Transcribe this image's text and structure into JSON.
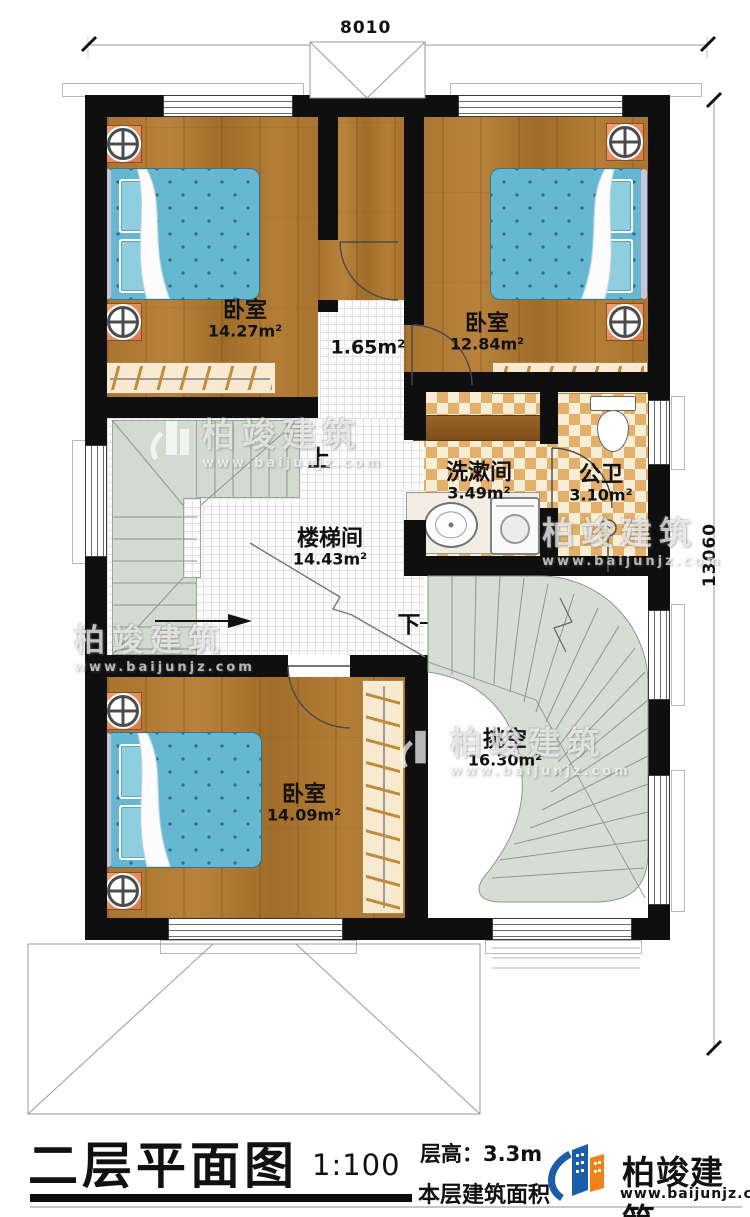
{
  "dimensions": {
    "top": "8010",
    "right": "13060"
  },
  "rooms": {
    "bedroom_tl": {
      "name": "卧室",
      "area": "14.27m²"
    },
    "bedroom_tr": {
      "name": "卧室",
      "area": "12.84m²"
    },
    "hall": {
      "area": "1.65m²"
    },
    "washroom": {
      "name": "洗漱间",
      "area": "3.49m²"
    },
    "toilet": {
      "name": "公卫",
      "area": "3.10m²"
    },
    "stairwell": {
      "name": "楼梯间",
      "area": "14.43m²"
    },
    "bedroom_b": {
      "name": "卧室",
      "area": "14.09m²"
    },
    "void": {
      "name": "挑空",
      "area": "16.30m²"
    }
  },
  "stairs": {
    "up": "上",
    "down": "下"
  },
  "watermark": {
    "brand": "柏竣建筑",
    "site": "www.baijunjz.com"
  },
  "titleblock": {
    "title": "二层平面图",
    "scale": "1:100",
    "floor_height": "层高：3.3m",
    "floor_area": "本层建筑面积",
    "brand": "柏竣建筑",
    "site": "www.baijunjz.com"
  },
  "colors": {
    "wood": "#ab7530",
    "bed_blue": "#66b8d2",
    "checker_tan": "#e3af6b",
    "stair_green": "#d3dbd0",
    "brand_blue": "#1a5dab",
    "brand_orange": "#f08119"
  }
}
